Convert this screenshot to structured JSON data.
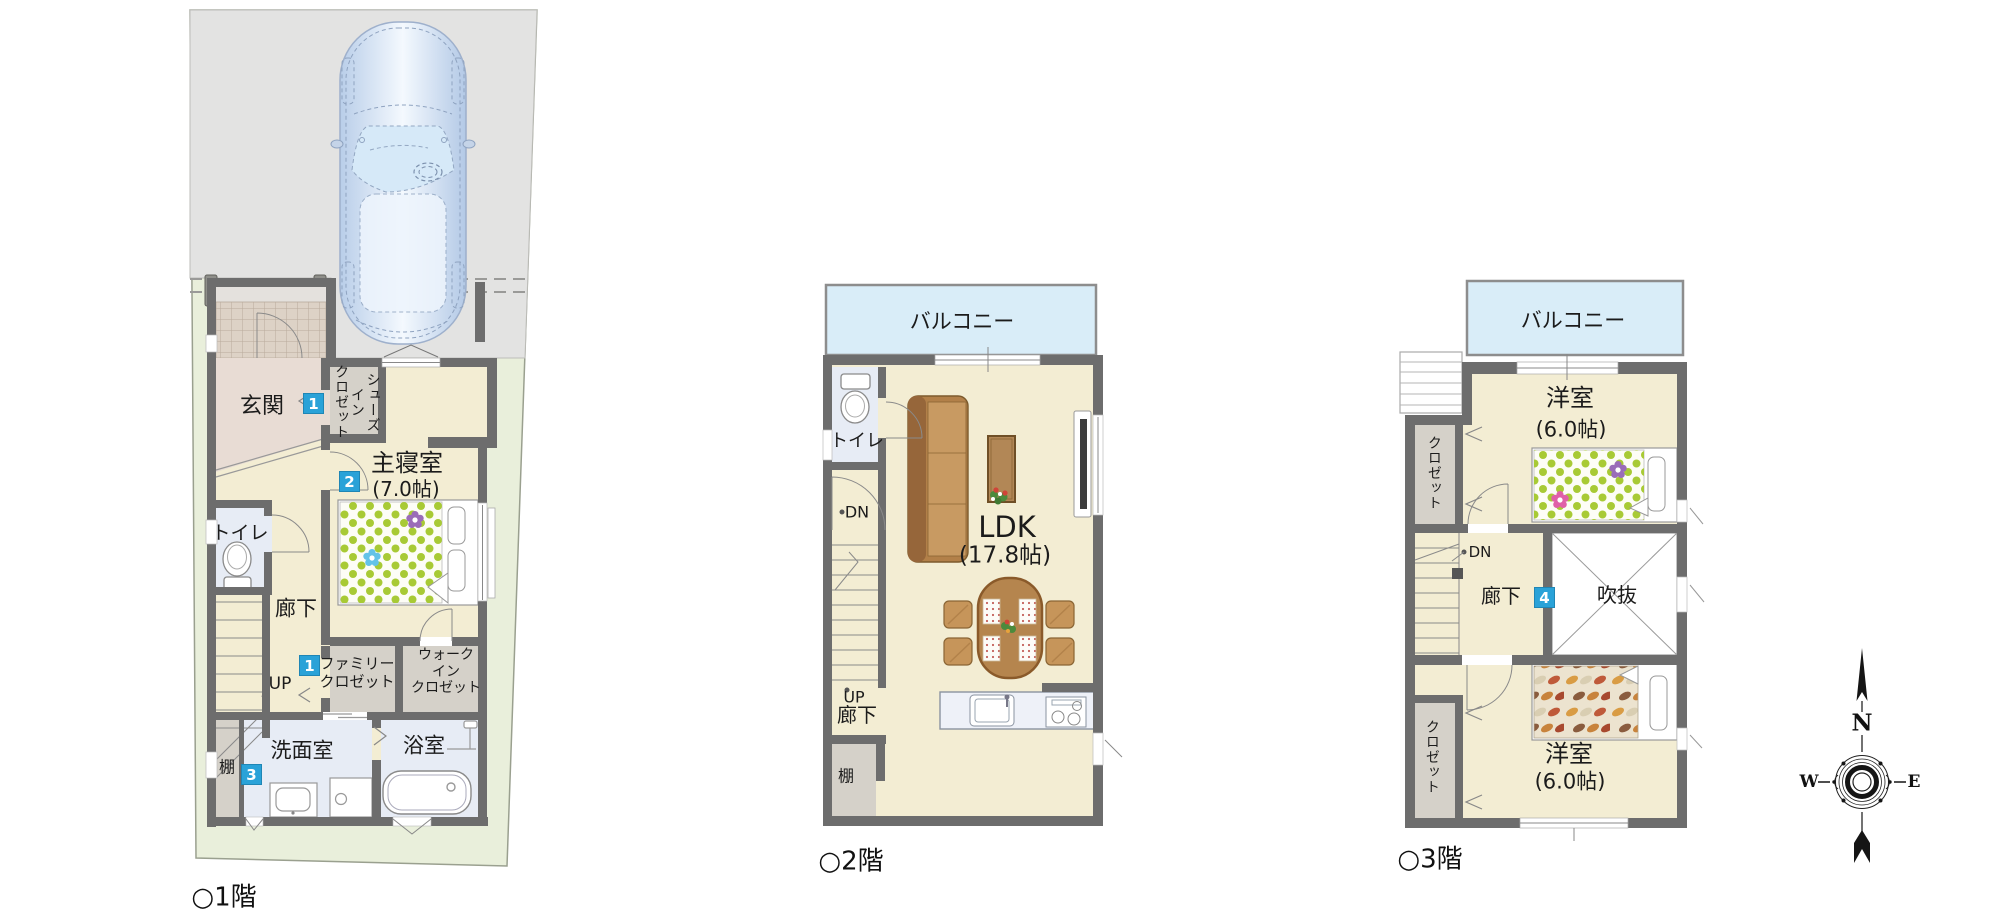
{
  "colors": {
    "badge-blue": "#2aa2d8",
    "balcony-blue": "#d9edf8",
    "floor-cream": "#f3edd3",
    "wall-gray": "#6d6d6d",
    "lot-green": "#e9efdb",
    "driveway-gray": "#e3e3e2",
    "wet-area-blue": "#e7ecf5",
    "closet-gray": "#d5d1c9",
    "polka-green": "#a8ca35",
    "wood-brown": "#8a5a2a"
  },
  "floors": [
    {
      "caption": "○1階",
      "labels": {
        "porch_entry": "玄関",
        "shoes_closet": "シューズ\nイン\nクロゼット",
        "master_bedroom": "主寝室",
        "master_bedroom_size": "(7.0帖)",
        "toilet": "トイレ",
        "hallway": "廊下",
        "stairs_up": "UP",
        "family_closet": "ファミリー\nクロゼット",
        "walk_in_closet": "ウォーク\nイン\nクロゼット",
        "washroom": "洗面室",
        "bathroom": "浴室",
        "shelf": "棚"
      },
      "badges": [
        {
          "n": "1"
        },
        {
          "n": "2"
        },
        {
          "n": "1"
        },
        {
          "n": "3"
        }
      ]
    },
    {
      "caption": "○2階",
      "labels": {
        "balcony": "バルコニー",
        "toilet": "トイレ",
        "stairs_down": "DN",
        "stairs_up": "UP",
        "hallway": "廊下",
        "shelf": "棚",
        "ldk": "LDK",
        "ldk_size": "(17.8帖)"
      },
      "badges": []
    },
    {
      "caption": "○3階",
      "labels": {
        "balcony": "バルコニー",
        "bedroom_north": "洋室",
        "bedroom_north_size": "(6.0帖)",
        "closet_north": "クロゼット",
        "stairs_down": "DN",
        "hallway": "廊下",
        "void": "吹抜",
        "bedroom_south": "洋室",
        "bedroom_south_size": "(6.0帖)",
        "closet_south": "クロゼット"
      },
      "badges": [
        {
          "n": "4"
        }
      ]
    }
  ],
  "compass": {
    "north": "N",
    "west": "W",
    "east": "E"
  }
}
